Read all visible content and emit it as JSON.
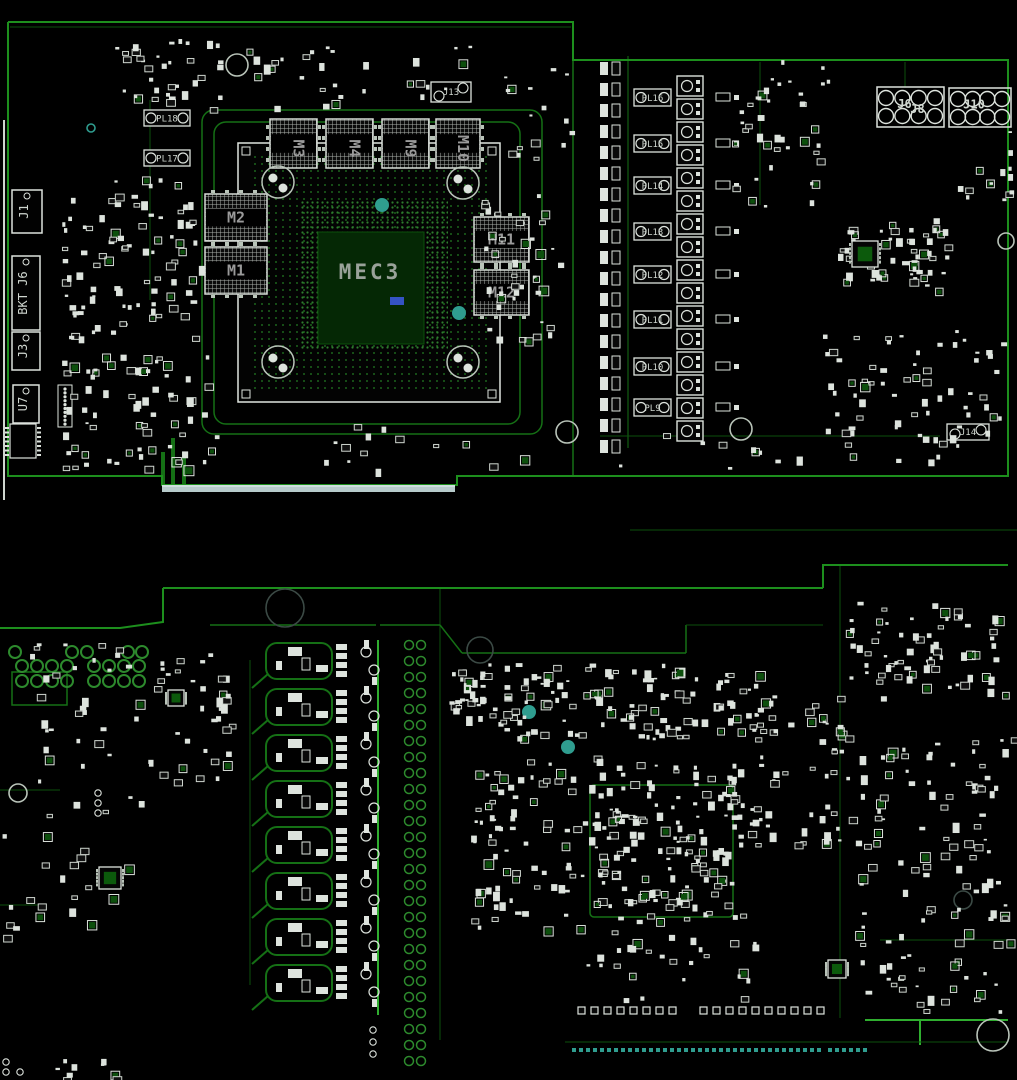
{
  "drawing": {
    "type": "pcb-assembly-drawing",
    "gpu_label": "MEC3",
    "gpu_sub_marker": "blue-tag"
  },
  "colors": {
    "bg": "#000000",
    "edge": "#1d8f1d",
    "trace": "#157015",
    "traceDim": "#0b4f0b",
    "traceBright": "#2fae2f",
    "white": "#dde3dd",
    "whiteDim": "#b9c4b9",
    "silk": "#cfd6cf",
    "gray": "#9aa29a",
    "teal": "#2f9d8f",
    "fingers": "#b7cbcb",
    "blue": "#3553c4",
    "padGreen": "#2d8a2d",
    "chipBg": "#0a0a0a"
  },
  "seed": 1337,
  "front": {
    "outline": [
      [
        8,
        22
      ],
      [
        573,
        22
      ],
      [
        573,
        60
      ],
      [
        1008,
        60
      ],
      [
        1008,
        476
      ],
      [
        457,
        476
      ],
      [
        457,
        485
      ],
      [
        162,
        485
      ],
      [
        162,
        476
      ],
      [
        8,
        476
      ],
      [
        8,
        22
      ]
    ],
    "bracket_line": {
      "x": 4,
      "y1": 120,
      "y2": 500
    },
    "fingers": {
      "x": 162,
      "y": 485,
      "w": 293,
      "h": 7
    },
    "bga": {
      "label": "MEC3",
      "x": 238,
      "y": 143,
      "w": 262,
      "h": 259
    },
    "memories": [
      {
        "ref": "M3",
        "x": 270,
        "y": 119,
        "w": 47,
        "h": 49,
        "vertical": true
      },
      {
        "ref": "M4",
        "x": 326,
        "y": 119,
        "w": 47,
        "h": 49,
        "vertical": true
      },
      {
        "ref": "M9",
        "x": 382,
        "y": 119,
        "w": 47,
        "h": 49,
        "vertical": true
      },
      {
        "ref": "M10",
        "x": 436,
        "y": 119,
        "w": 44,
        "h": 49,
        "vertical": true
      },
      {
        "ref": "M2",
        "x": 205,
        "y": 194,
        "w": 62,
        "h": 47,
        "vertical": false
      },
      {
        "ref": "M1",
        "x": 205,
        "y": 247,
        "w": 62,
        "h": 47,
        "vertical": false
      },
      {
        "ref": "M11",
        "x": 474,
        "y": 217,
        "w": 55,
        "h": 45,
        "vertical": false
      },
      {
        "ref": "M12",
        "x": 474,
        "y": 270,
        "w": 55,
        "h": 45,
        "vertical": false
      }
    ],
    "inductors_left": [
      {
        "ref": "PL18",
        "x": 144,
        "y": 110,
        "w": 46,
        "h": 16
      },
      {
        "ref": "PL17",
        "x": 144,
        "y": 150,
        "w": 46,
        "h": 16
      }
    ],
    "inductors_right": [
      {
        "ref": "PL16",
        "x": 634,
        "y": 89,
        "w": 37,
        "h": 17
      },
      {
        "ref": "PL15",
        "x": 634,
        "y": 135,
        "w": 37,
        "h": 17
      },
      {
        "ref": "PL14",
        "x": 634,
        "y": 177,
        "w": 37,
        "h": 17
      },
      {
        "ref": "PL13",
        "x": 634,
        "y": 223,
        "w": 37,
        "h": 17
      },
      {
        "ref": "PL12",
        "x": 634,
        "y": 266,
        "w": 37,
        "h": 17
      },
      {
        "ref": "PL11",
        "x": 634,
        "y": 311,
        "w": 37,
        "h": 17
      },
      {
        "ref": "PL10",
        "x": 634,
        "y": 358,
        "w": 37,
        "h": 17
      },
      {
        "ref": "PL9",
        "x": 634,
        "y": 399,
        "w": 37,
        "h": 17
      }
    ],
    "edge_connectors": [
      {
        "ref": "J1",
        "x": 12,
        "y": 190,
        "w": 30,
        "h": 43
      },
      {
        "ref": "BKT J6",
        "x": 12,
        "y": 256,
        "w": 28,
        "h": 74
      },
      {
        "ref": "J3",
        "x": 12,
        "y": 332,
        "w": 28,
        "h": 38
      },
      {
        "ref": "U7",
        "x": 13,
        "y": 385,
        "w": 26,
        "h": 38
      }
    ],
    "power_headers": [
      {
        "refs": [
          "J6",
          "J8"
        ],
        "x": 877,
        "y": 87,
        "w": 67,
        "h": 40,
        "rows": 2,
        "cols": 4
      },
      {
        "refs": [
          "J10"
        ],
        "x": 949,
        "y": 88,
        "w": 62,
        "h": 39,
        "rows": 2,
        "cols": 4
      }
    ],
    "small_headers": [
      {
        "ref": "J13",
        "x": 431,
        "y": 82,
        "w": 40,
        "h": 20
      },
      {
        "ref": "J14",
        "x": 947,
        "y": 424,
        "w": 42,
        "h": 16
      }
    ],
    "fiducials": [
      [
        278,
        182
      ],
      [
        463,
        183
      ],
      [
        278,
        362
      ],
      [
        463,
        362
      ]
    ],
    "holes": [
      {
        "x": 237,
        "y": 65,
        "r": 11,
        "c": "whiteDim"
      },
      {
        "x": 567,
        "y": 432,
        "r": 11,
        "c": "whiteDim"
      },
      {
        "x": 741,
        "y": 429,
        "r": 11,
        "c": "whiteDim"
      },
      {
        "x": 1006,
        "y": 241,
        "r": 8,
        "c": "whiteDim"
      },
      {
        "x": 91,
        "y": 128,
        "r": 4,
        "c": "teal"
      }
    ],
    "teal_dots": [
      [
        382,
        205
      ],
      [
        459,
        313
      ]
    ],
    "loops": [
      [
        214,
        122,
        306,
        302
      ],
      [
        202,
        110,
        340,
        324
      ]
    ],
    "cap_strip": {
      "x": 600,
      "y0": 62,
      "step": 21,
      "n": 19
    },
    "phase_squares": {
      "x": 677,
      "y0": 76,
      "step": 23,
      "n": 16,
      "w": 26,
      "h": 20
    },
    "traces": [
      [
        573,
        60,
        573,
        476,
        "trace",
        1.5
      ],
      [
        628,
        56,
        628,
        448,
        "trace",
        1
      ],
      [
        10,
        27,
        571,
        27,
        "traceDim",
        1
      ],
      [
        760,
        62,
        760,
        205,
        "traceDim",
        1
      ],
      [
        600,
        436,
        940,
        436,
        "traceDim",
        1
      ],
      [
        150,
        100,
        150,
        300,
        "traceDim",
        1
      ],
      [
        905,
        62,
        905,
        87,
        "traceDim",
        1
      ],
      [
        630,
        530,
        1017,
        530,
        "traceDim",
        1
      ],
      [
        163,
        452,
        163,
        486,
        "trace",
        4
      ],
      [
        173,
        438,
        173,
        486,
        "trace",
        4
      ],
      [
        184,
        452,
        184,
        486,
        "trace",
        4
      ]
    ],
    "clusters": [
      [
        110,
        35,
        120,
        75,
        35
      ],
      [
        60,
        175,
        140,
        150,
        85
      ],
      [
        60,
        330,
        155,
        140,
        75
      ],
      [
        240,
        45,
        230,
        62,
        30
      ],
      [
        480,
        190,
        80,
        148,
        40
      ],
      [
        500,
        60,
        70,
        100,
        16
      ],
      [
        732,
        60,
        98,
        148,
        40
      ],
      [
        838,
        218,
        110,
        74,
        55
      ],
      [
        820,
        330,
        184,
        130,
        70
      ],
      [
        320,
        420,
        240,
        50,
        14
      ],
      [
        600,
        428,
        220,
        42,
        10
      ],
      [
        955,
        130,
        55,
        80,
        14
      ]
    ],
    "qfns": [
      {
        "x": 852,
        "y": 241,
        "s": 26
      }
    ]
  },
  "back": {
    "outline_segments": [
      [
        [
          163,
          588
        ],
        [
          823,
          588
        ]
      ],
      [
        [
          823,
          588
        ],
        [
          823,
          565
        ],
        [
          1008,
          565
        ]
      ],
      [
        [
          163,
          588
        ],
        [
          163,
          622
        ],
        [
          120,
          628
        ],
        [
          0,
          628
        ]
      ]
    ],
    "traces": [
      [
        378,
        640,
        378,
        1015,
        "traceBright",
        2
      ],
      [
        250,
        660,
        250,
        985,
        "traceDim",
        1
      ],
      [
        440,
        588,
        440,
        1040,
        "traceDim",
        1
      ],
      [
        210,
        625,
        376,
        625,
        "trace",
        1.5
      ],
      [
        380,
        625,
        440,
        625,
        "trace",
        1.5
      ],
      [
        440,
        625,
        462,
        653,
        "trace",
        1.5
      ],
      [
        462,
        653,
        686,
        653,
        "trace",
        1.5
      ],
      [
        686,
        653,
        686,
        625,
        "trace",
        1.5
      ],
      [
        686,
        625,
        823,
        625,
        "traceDim",
        1
      ],
      [
        840,
        565,
        840,
        1018,
        "traceDim",
        1
      ],
      [
        865,
        1020,
        1008,
        1020,
        "traceBright",
        2
      ],
      [
        920,
        1020,
        920,
        1045,
        "traceBright",
        2
      ],
      [
        565,
        1042,
        1008,
        1042,
        "traceDim",
        1
      ],
      [
        880,
        940,
        1008,
        940,
        "traceDim",
        1
      ],
      [
        0,
        790,
        60,
        790,
        "traceDim",
        1
      ],
      [
        0,
        905,
        40,
        905,
        "traceDim",
        1
      ]
    ],
    "phases": {
      "x": 266,
      "y0": 660,
      "step": 46,
      "n": 8
    },
    "via_cols": {
      "x1": 409,
      "x2": 421,
      "y0": 645,
      "step": 16,
      "n": 27,
      "r": 4.5
    },
    "ring_grid": {
      "r": 6,
      "rows": [
        {
          "y": 652,
          "xs": [
            15,
            72,
            87,
            128,
            142
          ]
        },
        {
          "y": 666,
          "xs": [
            22,
            37,
            52,
            67,
            94,
            109,
            124,
            139
          ]
        },
        {
          "y": 681,
          "xs": [
            22,
            37,
            52,
            67,
            94,
            109,
            124,
            139
          ]
        }
      ]
    },
    "green_rect": [
      12,
      672,
      55,
      33
    ],
    "gpu_back": {
      "x": 590,
      "y": 785,
      "w": 143,
      "h": 132
    },
    "pad_row": {
      "y": 1007,
      "x0": 578,
      "step": 13,
      "n": 18,
      "s": 7,
      "gap_after": 8,
      "gap": 18
    },
    "teal_dashes": [
      {
        "x0": 572,
        "x1": 820,
        "y": 1048
      },
      {
        "x0": 828,
        "x1": 868,
        "y": 1048
      }
    ],
    "holes": [
      {
        "x": 285,
        "y": 608,
        "r": 19,
        "c": "#3b4a45"
      },
      {
        "x": 480,
        "y": 650,
        "r": 13,
        "c": "#3b4a45"
      },
      {
        "x": 18,
        "y": 793,
        "r": 9,
        "c": "whiteDim"
      },
      {
        "x": 993,
        "y": 1035,
        "r": 16,
        "c": "whiteDim"
      },
      {
        "x": 963,
        "y": 900,
        "r": 9,
        "c": "#3b4a45"
      }
    ],
    "small_rings": [
      [
        98,
        793
      ],
      [
        98,
        803
      ],
      [
        98,
        813
      ],
      [
        373,
        1030
      ],
      [
        373,
        1042
      ],
      [
        373,
        1054
      ],
      [
        6,
        1062
      ],
      [
        6,
        1072
      ],
      [
        20,
        1072
      ]
    ],
    "teal_dots": [
      [
        529,
        712
      ],
      [
        568,
        747
      ]
    ],
    "clusters": [
      [
        448,
        660,
        314,
        78,
        150
      ],
      [
        470,
        755,
        130,
        178,
        85
      ],
      [
        592,
        762,
        150,
        158,
        150
      ],
      [
        745,
        695,
        105,
        150,
        60
      ],
      [
        838,
        600,
        172,
        100,
        70
      ],
      [
        855,
        735,
        157,
        278,
        115
      ],
      [
        30,
        640,
        200,
        140,
        70
      ],
      [
        0,
        790,
        140,
        150,
        25
      ],
      [
        585,
        930,
        185,
        70,
        28
      ],
      [
        50,
        1058,
        80,
        20,
        10
      ]
    ],
    "qfns": [
      {
        "x": 828,
        "y": 960,
        "s": 18
      },
      {
        "x": 99,
        "y": 867,
        "s": 22
      },
      {
        "x": 168,
        "y": 690,
        "s": 16
      }
    ]
  }
}
